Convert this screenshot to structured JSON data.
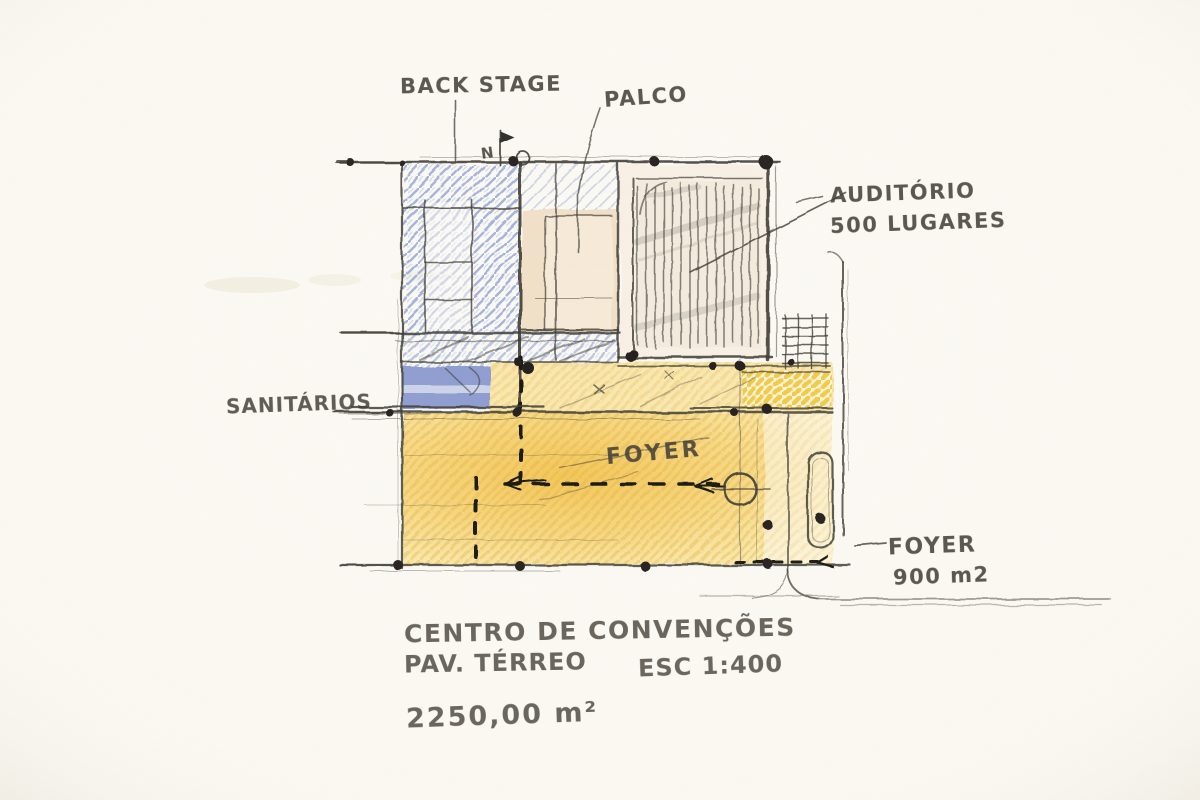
{
  "sketch": {
    "plan_labels": {
      "backstage": "BACK STAGE",
      "palco": "PALCO",
      "auditorio": [
        "AUDITÓRIO",
        "500 LUGARES"
      ],
      "sanitarios": "SANITÁRIOS",
      "foyer": "FOYER",
      "foyer_area": [
        "FOYER",
        "900 m2"
      ],
      "north": "N"
    },
    "title_block": {
      "project": "CENTRO DE CONVENÇÕES",
      "floor": "PAV. TÉRREO",
      "scale": "ESC 1:400",
      "total_area": "2250,00 m²"
    },
    "colors": {
      "paper": "#fcfaf4",
      "graphite": "#3b3831",
      "blue_pencil": "#8fa2d6",
      "blue_solid": "#8292cd",
      "yellow_pencil": "#e8b445",
      "yellow_light": "#f9e6a2",
      "bright_yellow": "#f1c735",
      "cream": "#f1dfc7"
    }
  }
}
